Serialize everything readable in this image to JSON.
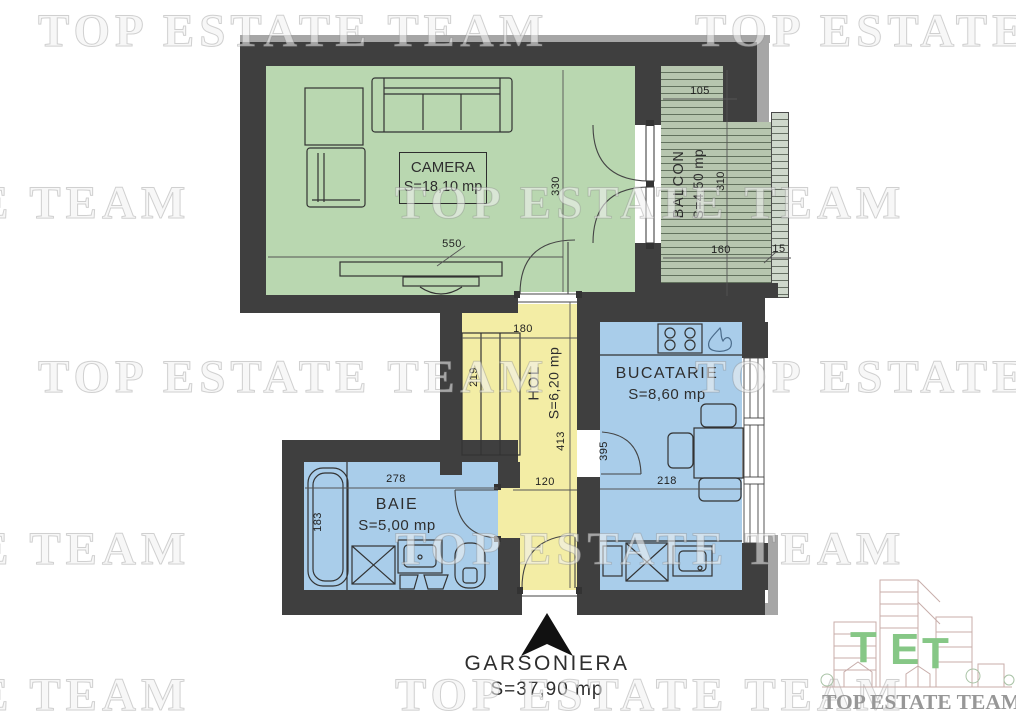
{
  "plan": {
    "rooms": {
      "camera": {
        "name": "CAMERA",
        "area": "S=18,10 mp"
      },
      "balcon": {
        "name": "BALCON",
        "area": "S=4,50 mp"
      },
      "hol": {
        "name": "HOL",
        "area": "S=6,20 mp"
      },
      "bucatarie": {
        "name": "BUCATARIE",
        "area": "S=8,60 mp"
      },
      "baie": {
        "name": "BAIE",
        "area": "S=5,00 mp"
      }
    },
    "dimensions": {
      "camera_width": "550",
      "camera_height": "330",
      "balcon_niche": "105",
      "balcon_height": "310",
      "balcon_width": "160",
      "balcon_rail": "15",
      "hol_top": "180",
      "hol_closet": "219",
      "hol_height": "413",
      "hol_width": "120",
      "baie_width": "278",
      "baie_height": "183",
      "bucatarie_height": "395",
      "bucatarie_width": "218"
    },
    "footer": {
      "title": "GARSONIERA",
      "area": "S=37,90 mp"
    }
  },
  "watermark": {
    "text": "TOP ESTATE TEAM"
  },
  "logo": {
    "letters": [
      "T",
      "E",
      "T"
    ],
    "caption": "TOP ESTATE TEAM"
  },
  "colors": {
    "wall": "#3f3f3f",
    "camera_fill": "#b9d7b0",
    "balcon_fill": "#b7c6af",
    "hol_fill": "#f3eda5",
    "wet_room_fill": "#a9cdea",
    "logo_green": "#86c786"
  }
}
